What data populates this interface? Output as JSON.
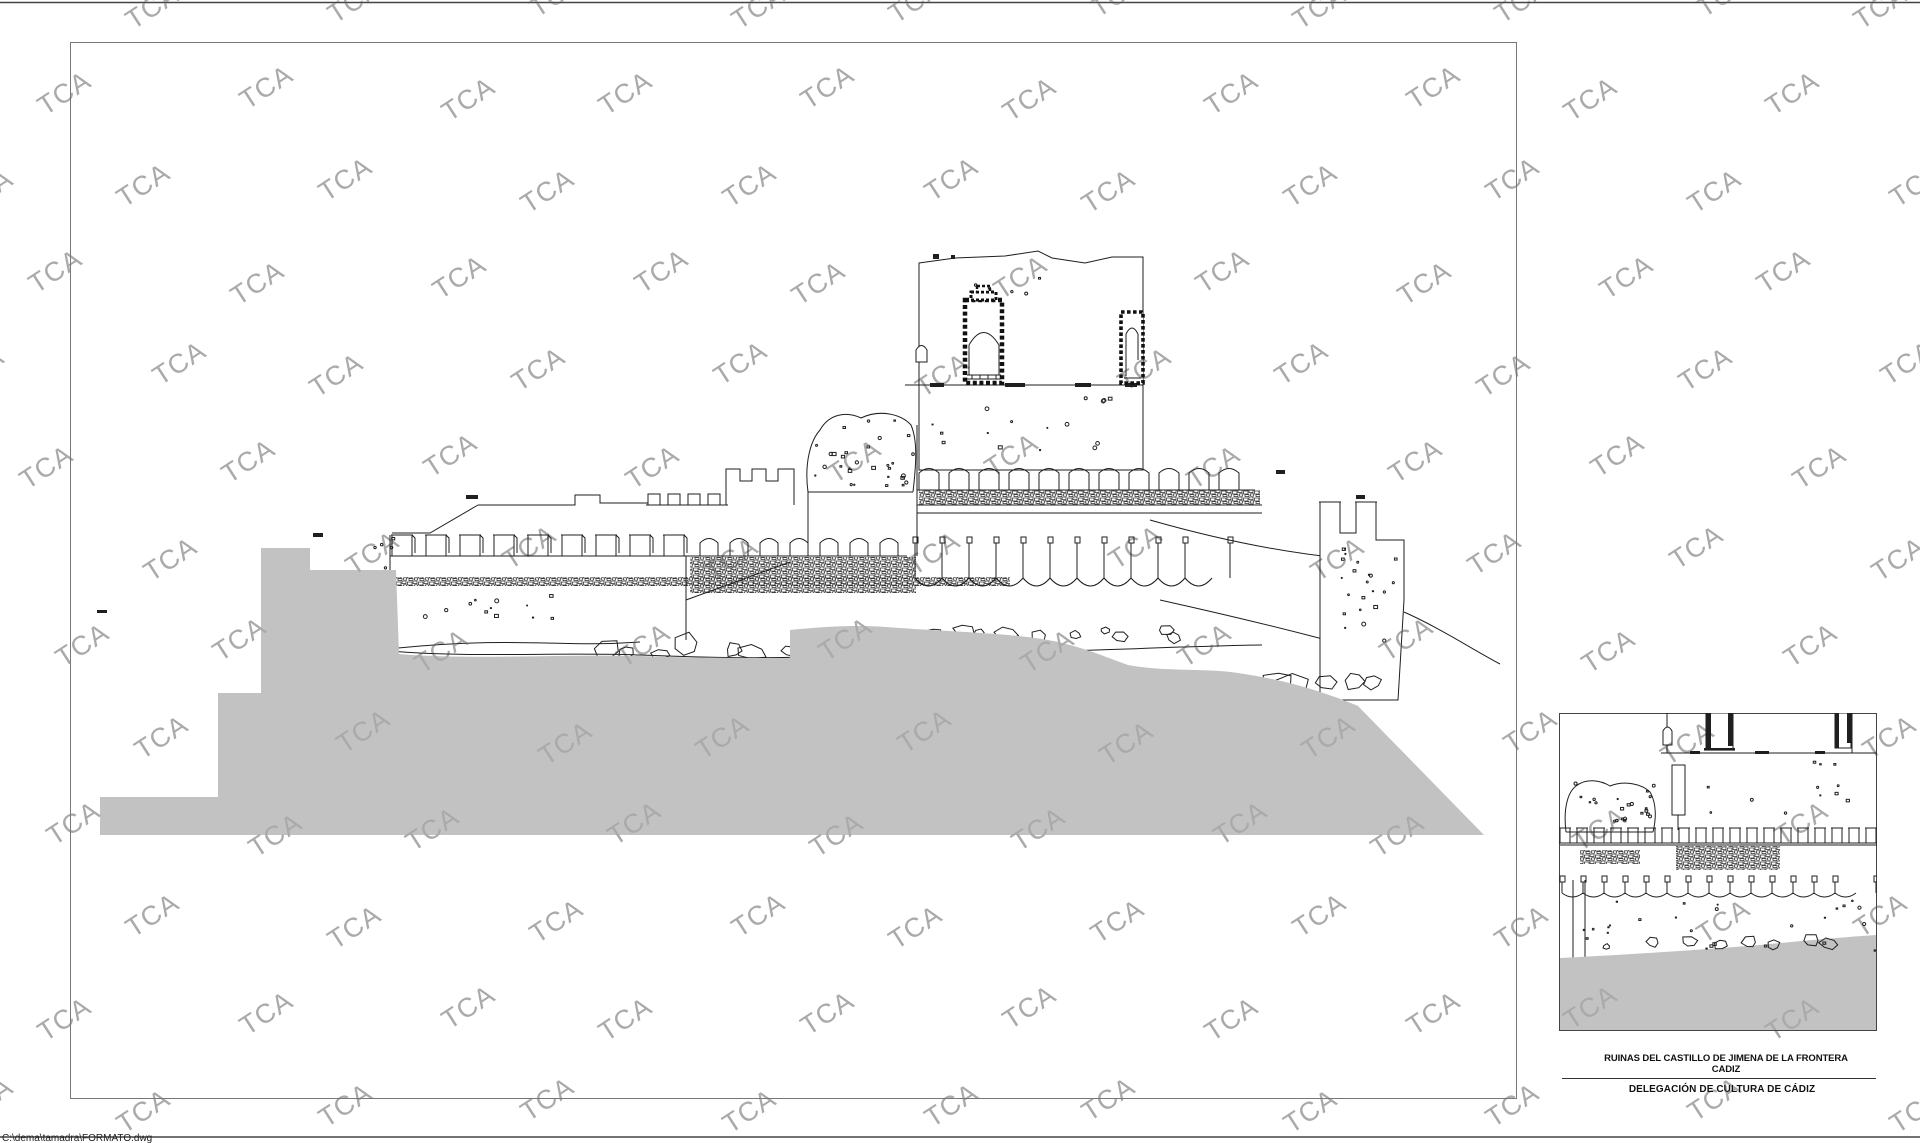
{
  "page": {
    "file_path_label": "C:\\dema\\tamadra\\FORMATO.dwg"
  },
  "watermark": {
    "text": "TCA",
    "color": "#aaaaaa"
  },
  "title_block": {
    "line1": "RUINAS DEL CASTILLO DE JIMENA DE LA FRONTERA",
    "line2": "CADIZ",
    "line3": "DELEGACIÓN DE CULTURA DE CÁDIZ"
  },
  "drawing": {
    "line_color": "#1f1f1f",
    "terrain_color": "#c2c2c2",
    "border_color": "#777777",
    "page_rule_color": "#444444"
  }
}
